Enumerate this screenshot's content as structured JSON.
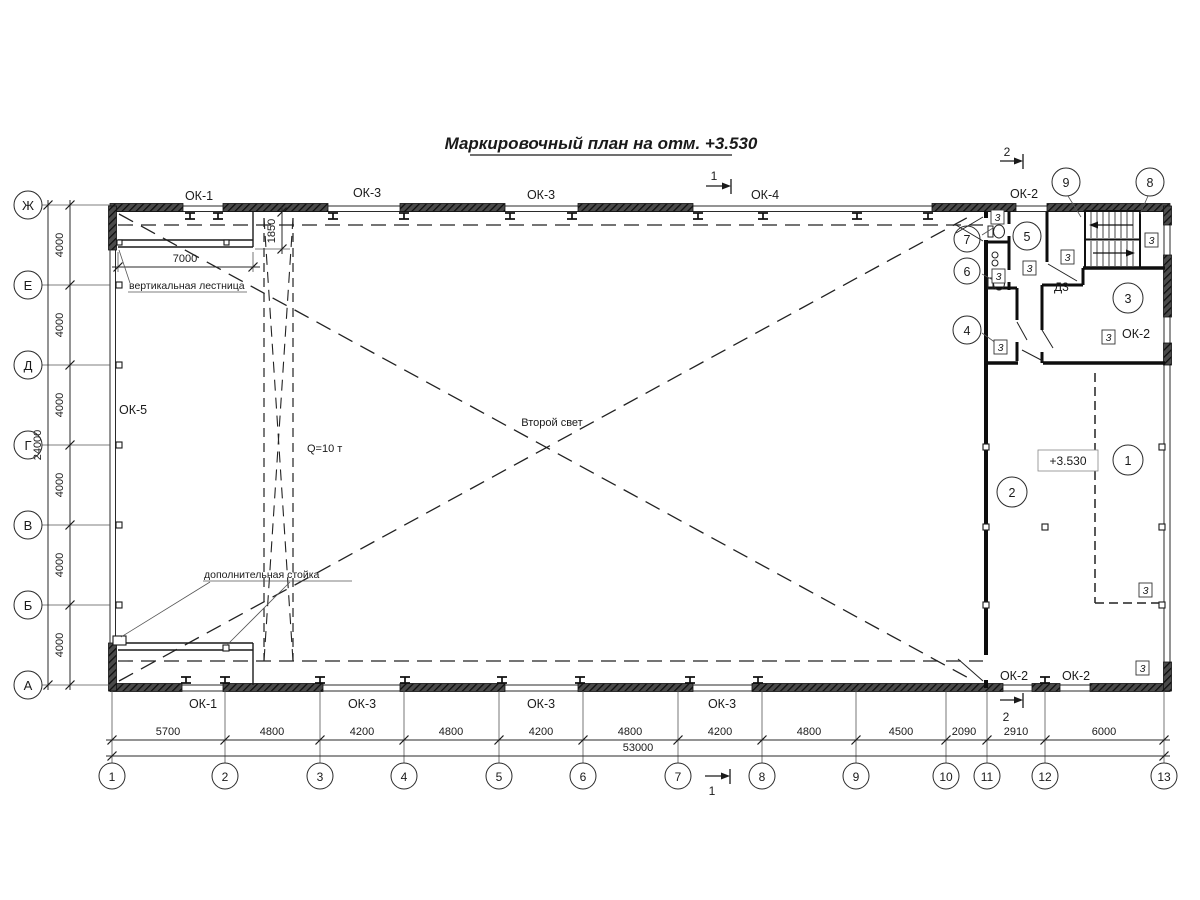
{
  "title": "Маркировочный план на отм. +3.530",
  "axes": {
    "rows": [
      "Ж",
      "Е",
      "Д",
      "Г",
      "В",
      "Б",
      "А"
    ],
    "cols": [
      "1",
      "2",
      "3",
      "4",
      "5",
      "6",
      "7",
      "8",
      "9",
      "10",
      "11",
      "12",
      "13"
    ]
  },
  "dims": {
    "row": [
      "4000",
      "4000",
      "4000",
      "4000",
      "4000",
      "4000"
    ],
    "row_total": "24000",
    "col": [
      "5700",
      "4800",
      "4200",
      "4800",
      "4200",
      "4800",
      "4200",
      "4800",
      "4500",
      "2090",
      "2910",
      "6000"
    ],
    "col_total": "53000",
    "platform": "7000",
    "ladder_band": "1850"
  },
  "windows": {
    "top": [
      "ОК-1",
      "ОК-3",
      "ОК-3",
      "ОК-4",
      "ОК-2"
    ],
    "bottom": [
      "ОК-1",
      "ОК-3",
      "ОК-3",
      "ОК-3",
      "ОК-2",
      "ОК-2"
    ],
    "left": "ОК-5",
    "right": "ОК-2"
  },
  "rooms": [
    "1",
    "2",
    "3",
    "4",
    "5",
    "6",
    "7",
    "8",
    "9"
  ],
  "labels": {
    "second_light": "Второй свет",
    "crane": "Q=10 т",
    "level": "+3.530",
    "door": "Д3",
    "ladder": "вертикальная лестница",
    "post": "дополнительная стойка",
    "tag": "3"
  },
  "sections": {
    "s1": "1",
    "s2": "2"
  },
  "colors": {
    "line": "#1f1f1f",
    "hatch": "#3a3a3a"
  }
}
